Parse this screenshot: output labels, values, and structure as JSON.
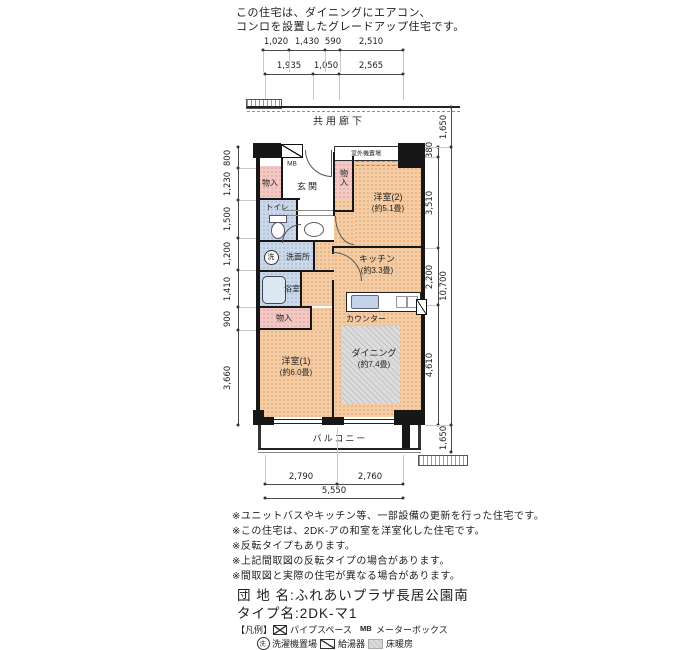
{
  "header": {
    "line1": "この住宅は、ダイニングにエアコン、",
    "line2": "コンロを設置したグレードアップ住宅です。"
  },
  "corridor": {
    "label": "共用廊下"
  },
  "balcony": {
    "label": "バルコニー"
  },
  "plan": {
    "outdoor_unit": "室外機置場",
    "mb": "MB",
    "closet_top": "物入",
    "entrance": "玄関",
    "closet_side": "物入",
    "western2_name": "洋室(2)",
    "western2_size": "(約5.1畳)",
    "toilet": "トイレ",
    "washroom": "洗面所",
    "washer_symbol": "洗",
    "bathroom": "浴室",
    "kitchen_name": "キッチン",
    "kitchen_size": "(約3.3畳)",
    "counter": "カウンター",
    "closet_mid": "物入",
    "western1_name": "洋室(1)",
    "western1_size": "(約6.0畳)",
    "dining_name": "ダイニング",
    "dining_size": "(約7.4畳)"
  },
  "dims": {
    "top_row1": [
      "1,020",
      "1,430",
      "590",
      "2,510"
    ],
    "top_row2": [
      "1,935",
      "1,050",
      "2,565"
    ],
    "left": [
      "800",
      "1,230",
      "1,500",
      "1,200",
      "1,410",
      "900",
      "3,660"
    ],
    "right": [
      "380",
      "3,510",
      "2,200",
      "4,610"
    ],
    "right_total": "10,700",
    "corridor_depth": "1,650",
    "balcony_depth": "1,650",
    "bottom": [
      "2,790",
      "2,760"
    ],
    "bottom_total": "5,550"
  },
  "notes": [
    "※ユニットバスやキッチン等、一部設備の更新を行った住宅です。",
    "※この住宅は、2DK-アの和室を洋室化した住宅です。",
    "※反転タイプもあります。",
    "※上記間取図の反転タイプの場合があります。",
    "※間取図と実際の住宅が異なる場合があります。"
  ],
  "title": {
    "line1": "団 地 名:ふれあいプラザ長居公園南",
    "line2": "タイプ名:2DK-マ1"
  },
  "legend": {
    "title": "【凡例】",
    "items": [
      {
        "name": "pipe-space",
        "label": "パイプスペース"
      },
      {
        "name": "meter-box",
        "symbol": "MB",
        "label": "メーターボックス"
      },
      {
        "name": "washer-place",
        "symbol": "洗",
        "label": "洗濯機置場"
      },
      {
        "name": "water-heater",
        "label": "給湯器"
      },
      {
        "name": "floor-heating",
        "label": "床暖房"
      }
    ]
  },
  "colors": {
    "room_peach": "#f4cda4",
    "room_blue": "#cbd8e9",
    "closet_pink": "#f3c9c6",
    "floor_heating_gray": "#dcdcdc",
    "wall": "#171717"
  }
}
